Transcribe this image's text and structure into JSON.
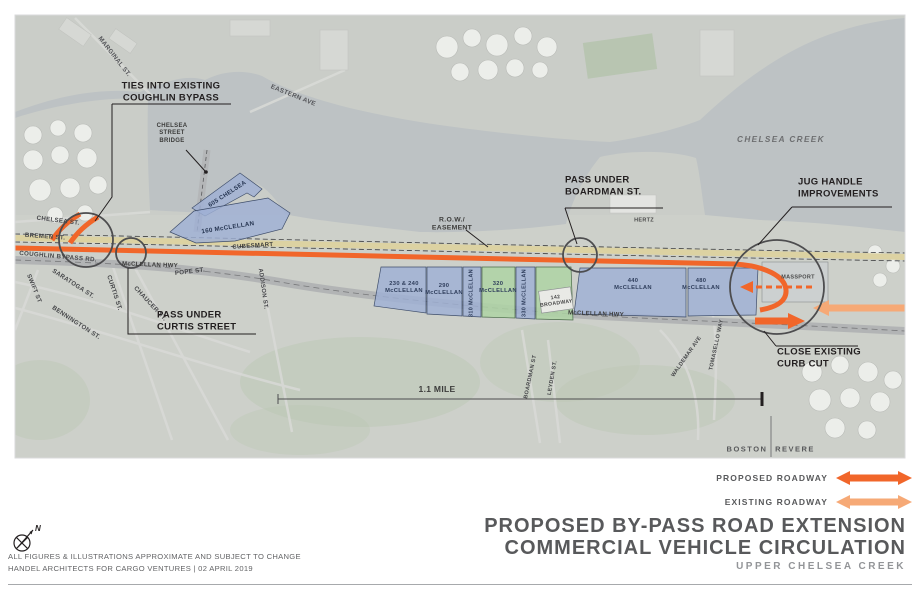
{
  "colors": {
    "proposed_roadway": "#f1662a",
    "existing_roadway": "#f6a976",
    "parcel_blue": "#9fb0d4",
    "parcel_green": "#aed3a4",
    "rail_band": "#dcd2a2",
    "water": "#bdc2c4",
    "land": "#cdd0ca",
    "annotation_circle": "#4d4d4f",
    "text_dark": "#231f20"
  },
  "map": {
    "labels": [
      {
        "id": "ties-into-coughlin",
        "text": "TIES INTO EXISTING\nCOUGHLIN BYPASS",
        "x": 171,
        "y": 92,
        "size": 9.5,
        "weight": 700,
        "color": "#231f20"
      },
      {
        "id": "marginal-st",
        "text": "MARGINAL ST.",
        "x": 114,
        "y": 57,
        "rot": 52,
        "size": 6.4,
        "color": "#55565a"
      },
      {
        "id": "eastern-ave",
        "text": "EASTERN AVE",
        "x": 293,
        "y": 96,
        "rot": 22,
        "size": 6.4,
        "color": "#55565a"
      },
      {
        "id": "chelsea-street-bridge",
        "text": "CHELSEA\nSTREET\nBRIDGE",
        "x": 172,
        "y": 134,
        "size": 6,
        "color": "#3c3c3b"
      },
      {
        "id": "chelsea-creek",
        "text": "CHELSEA CREEK",
        "x": 781,
        "y": 140,
        "size": 8.2,
        "italic": true,
        "spacing": 1.4,
        "color": "#6d6e70"
      },
      {
        "id": "chelsea-st",
        "text": "CHELSEA ST.",
        "x": 58,
        "y": 221,
        "rot": 7,
        "size": 6.2,
        "color": "#46474a"
      },
      {
        "id": "bremen-st",
        "text": "BREMEN ST.",
        "x": 45,
        "y": 237,
        "rot": 4,
        "size": 6.2,
        "color": "#46474a"
      },
      {
        "id": "coughlin-bypass-rd",
        "text": "COUGHLIN BYPASS RD.",
        "x": 58,
        "y": 257,
        "rot": 5,
        "size": 6.2,
        "color": "#46474a"
      },
      {
        "id": "swift-st",
        "text": "SWIFT ST",
        "x": 33,
        "y": 289,
        "rot": 68,
        "size": 6,
        "color": "#46474a"
      },
      {
        "id": "saratoga-st",
        "text": "SARATOGA ST.",
        "x": 73,
        "y": 284,
        "rot": 33,
        "size": 6.2,
        "color": "#46474a"
      },
      {
        "id": "curtis-st",
        "text": "CURTIS ST.",
        "x": 114,
        "y": 293,
        "rot": 72,
        "size": 6.2,
        "color": "#46474a"
      },
      {
        "id": "chaucer-st",
        "text": "CHAUCER ST.",
        "x": 150,
        "y": 304,
        "rot": 47,
        "size": 6.2,
        "color": "#46474a"
      },
      {
        "id": "bennington-st",
        "text": "BENNINGTON ST.",
        "x": 76,
        "y": 323,
        "rot": 33,
        "size": 6.2,
        "color": "#46474a"
      },
      {
        "id": "mcclellan-hwy-west",
        "text": "McCLELLAN HWY",
        "x": 150,
        "y": 266,
        "rot": 2,
        "size": 6,
        "color": "#3c3c3b"
      },
      {
        "id": "pope-st",
        "text": "POPE ST.",
        "x": 190,
        "y": 272,
        "rot": -7,
        "size": 6.2,
        "color": "#46474a"
      },
      {
        "id": "addison-st",
        "text": "ADDISON ST.",
        "x": 262,
        "y": 289,
        "rot": 82,
        "size": 6,
        "color": "#46474a"
      },
      {
        "id": "pass-under-curtis",
        "text": "PASS UNDER\nCURTIS STREET",
        "x": 157,
        "y": 321,
        "size": 9.5,
        "weight": 700,
        "align": "left",
        "color": "#231f20"
      },
      {
        "id": "parcel-605-chelsea",
        "text": "605 CHELSEA",
        "x": 228,
        "y": 195,
        "rot": -33,
        "size": 6,
        "color": "#273652"
      },
      {
        "id": "parcel-160-mcclellan",
        "text": "160 McCLELLAN",
        "x": 228,
        "y": 228,
        "rot": -9,
        "size": 6.2,
        "color": "#273652"
      },
      {
        "id": "cubesmart",
        "text": "CUBESMART",
        "x": 253,
        "y": 247,
        "rot": -4,
        "size": 6,
        "color": "#3c3c3b"
      },
      {
        "id": "row-easement",
        "text": "R.O.W./\nEASEMENT",
        "x": 452,
        "y": 225,
        "size": 6.8,
        "color": "#3c3c3b"
      },
      {
        "id": "parcel-230-240",
        "text": "230 & 240\nMcCLELLAN",
        "x": 404,
        "y": 288,
        "size": 5.8,
        "color": "#2f3e5c"
      },
      {
        "id": "parcel-290",
        "text": "290\nMcCLELLAN",
        "x": 444,
        "y": 290,
        "size": 5.8,
        "color": "#2f3e5c"
      },
      {
        "id": "parcel-310",
        "text": "310 McCLELLAN",
        "x": 472,
        "y": 293,
        "rot": -90,
        "size": 5.5,
        "color": "#2f3e5c"
      },
      {
        "id": "parcel-320",
        "text": "320\nMcCLELLAN",
        "x": 498,
        "y": 288,
        "size": 5.8,
        "color": "#2f3e5c"
      },
      {
        "id": "parcel-330",
        "text": "330 McCLELLAN",
        "x": 525,
        "y": 293,
        "rot": -90,
        "size": 5.5,
        "color": "#2f3e5c"
      },
      {
        "id": "parcel-142-broadway",
        "text": "142\nBROADWAY",
        "x": 556,
        "y": 301,
        "rot": -8,
        "size": 5.2,
        "color": "#4a4a4a"
      },
      {
        "id": "parcel-440",
        "text": "440\nMcCLELLAN",
        "x": 633,
        "y": 285,
        "size": 5.8,
        "color": "#2f3e5c"
      },
      {
        "id": "parcel-480",
        "text": "480\nMcCLELLAN",
        "x": 701,
        "y": 285,
        "size": 5.8,
        "color": "#2f3e5c"
      },
      {
        "id": "massport",
        "text": "MASSPORT",
        "x": 798,
        "y": 278,
        "size": 5.5,
        "color": "#4a4a4a"
      },
      {
        "id": "hertz",
        "text": "HERTZ",
        "x": 644,
        "y": 221,
        "size": 5.5,
        "color": "#4a4a4a"
      },
      {
        "id": "pass-under-boardman",
        "text": "PASS UNDER\nBOARDMAN ST.",
        "x": 565,
        "y": 186,
        "size": 9.5,
        "weight": 700,
        "align": "left",
        "color": "#231f20"
      },
      {
        "id": "jug-handle-improvements",
        "text": "JUG HANDLE\nIMPROVEMENTS",
        "x": 798,
        "y": 188,
        "size": 9.5,
        "weight": 700,
        "align": "left",
        "color": "#231f20"
      },
      {
        "id": "close-existing-curb-cut",
        "text": "CLOSE EXISTING\nCURB CUT",
        "x": 777,
        "y": 358,
        "size": 9.5,
        "weight": 700,
        "align": "left",
        "color": "#231f20"
      },
      {
        "id": "mile-dimension",
        "text": "1.1 MILE",
        "x": 437,
        "y": 389,
        "size": 8.5,
        "weight": 700,
        "color": "#3c3c3b"
      },
      {
        "id": "boston",
        "text": "BOSTON",
        "x": 747,
        "y": 449,
        "size": 7.5,
        "spacing": 1.5,
        "color": "#58595b"
      },
      {
        "id": "revere",
        "text": "REVERE",
        "x": 795,
        "y": 449,
        "size": 7.5,
        "spacing": 1.5,
        "color": "#58595b"
      },
      {
        "id": "boardman-st",
        "text": "BOARDMAN ST",
        "x": 531,
        "y": 377,
        "rot": -78,
        "size": 5.5,
        "color": "#46474a"
      },
      {
        "id": "leyden-st",
        "text": "LEYDEN ST.",
        "x": 553,
        "y": 378,
        "rot": -80,
        "size": 5.5,
        "color": "#46474a"
      },
      {
        "id": "waldemar-ave",
        "text": "WALDEMAR AVE",
        "x": 687,
        "y": 357,
        "rot": -55,
        "size": 5.5,
        "color": "#46474a"
      },
      {
        "id": "tomasello-way",
        "text": "TOMASELLO WAY",
        "x": 717,
        "y": 345,
        "rot": -78,
        "size": 5.5,
        "color": "#46474a"
      },
      {
        "id": "mcclellan-hwy-east",
        "text": "McCLELLAN HWY",
        "x": 596,
        "y": 315,
        "rot": 2,
        "size": 6,
        "color": "#3c3c3b"
      }
    ]
  },
  "legend": {
    "items": [
      {
        "label": "PROPOSED ROADWAY",
        "color": "#f1662a"
      },
      {
        "label": "EXISTING ROADWAY",
        "color": "#f6a976"
      }
    ]
  },
  "title_block": {
    "line1": "PROPOSED BY-PASS ROAD EXTENSION",
    "line2": "COMMERCIAL VEHICLE CIRCULATION",
    "line3": "UPPER CHELSEA CREEK"
  },
  "footer": {
    "disclaimer_line1": "ALL FIGURES & ILLUSTRATIONS APPROXIMATE AND SUBJECT TO CHANGE",
    "disclaimer_line2": "HANDEL ARCHITECTS FOR CARGO VENTURES   |   02 APRIL 2019",
    "north_label": "N"
  }
}
